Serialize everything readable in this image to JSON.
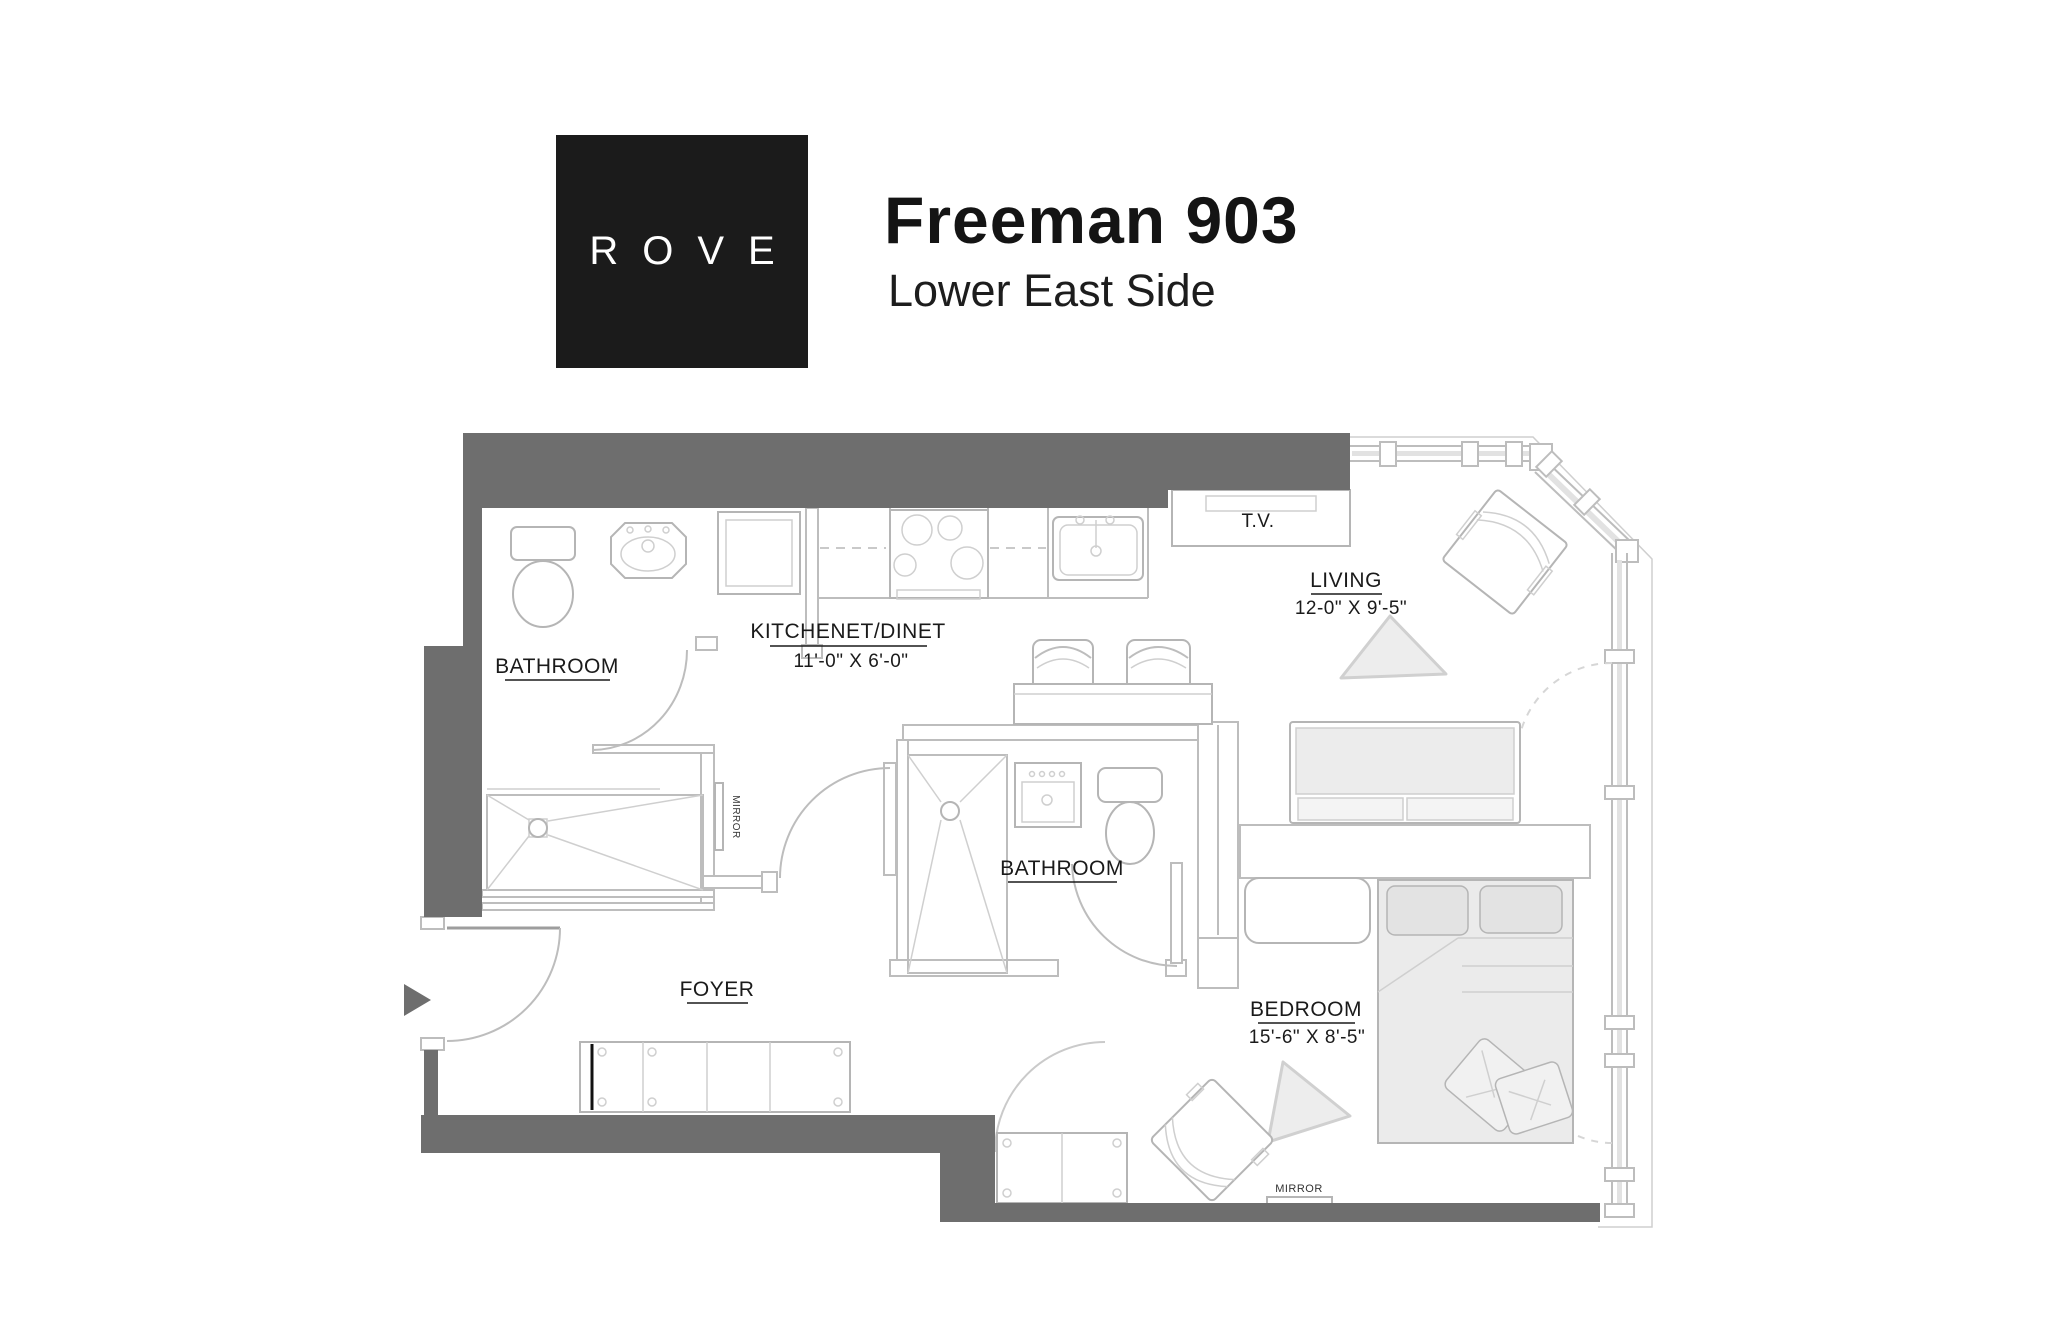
{
  "header": {
    "logo_text": "ROVE",
    "title": "Freeman 903",
    "subtitle": "Lower East Side"
  },
  "colors": {
    "wall_dark": "#6e6e6e",
    "line_light": "#bdbdbd",
    "furniture_fill": "#ededed",
    "window_pane": "#e2e2e2",
    "logo_bg": "#1b1b1b",
    "logo_text": "#ffffff",
    "text": "#1a1a1a"
  },
  "rooms": {
    "bathroom1": {
      "label": "BATHROOM"
    },
    "kitchen": {
      "label": "KITCHENET/DINET",
      "dim": "11'-0\" X 6'-0\""
    },
    "living": {
      "label": "LIVING",
      "dim": "12-0\" X 9'-5\""
    },
    "bathroom2": {
      "label": "BATHROOM"
    },
    "foyer": {
      "label": "FOYER"
    },
    "bedroom": {
      "label": "BEDROOM",
      "dim": "15'-6\" X 8'-5\""
    }
  },
  "annotations": {
    "tv": "T.V.",
    "mirror_bathroom": "MIRROR",
    "mirror_bedroom": "MIRROR"
  }
}
